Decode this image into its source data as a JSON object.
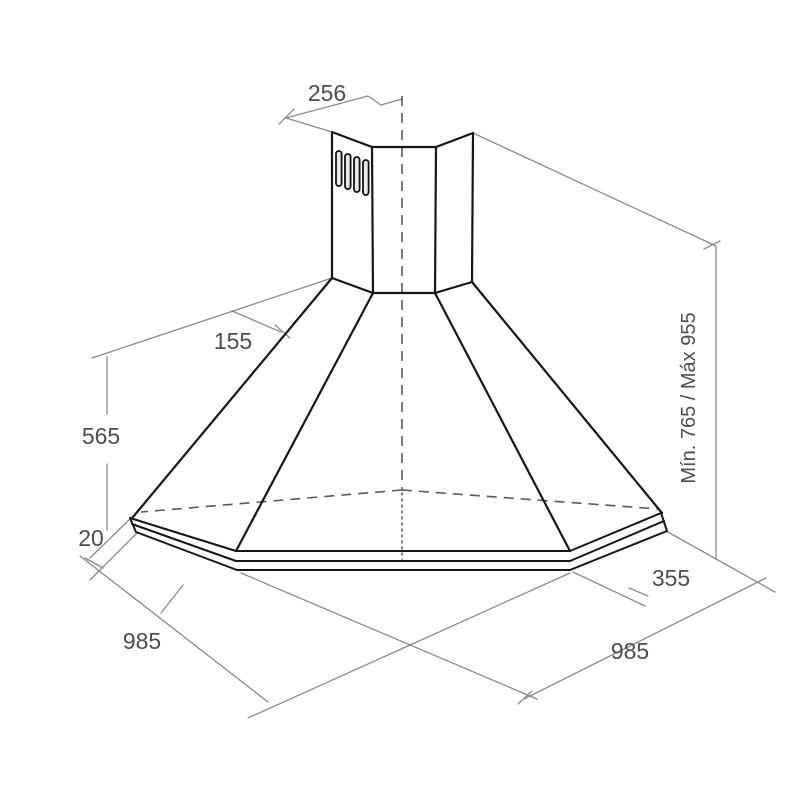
{
  "diagram": {
    "title": "corner-range-hood-dimension-drawing",
    "units": "mm",
    "dimensions": {
      "chimney_width": {
        "label": "256"
      },
      "wall_to_edge": {
        "label": "155"
      },
      "hood_body_height": {
        "label": "565"
      },
      "rim_height": {
        "label": "20"
      },
      "wall_width_left": {
        "label": "985"
      },
      "wall_width_right": {
        "label": "985"
      },
      "corner_depth": {
        "label": "355"
      },
      "total_height_range": {
        "label": "Mín. 765 / Máx 955"
      }
    }
  }
}
